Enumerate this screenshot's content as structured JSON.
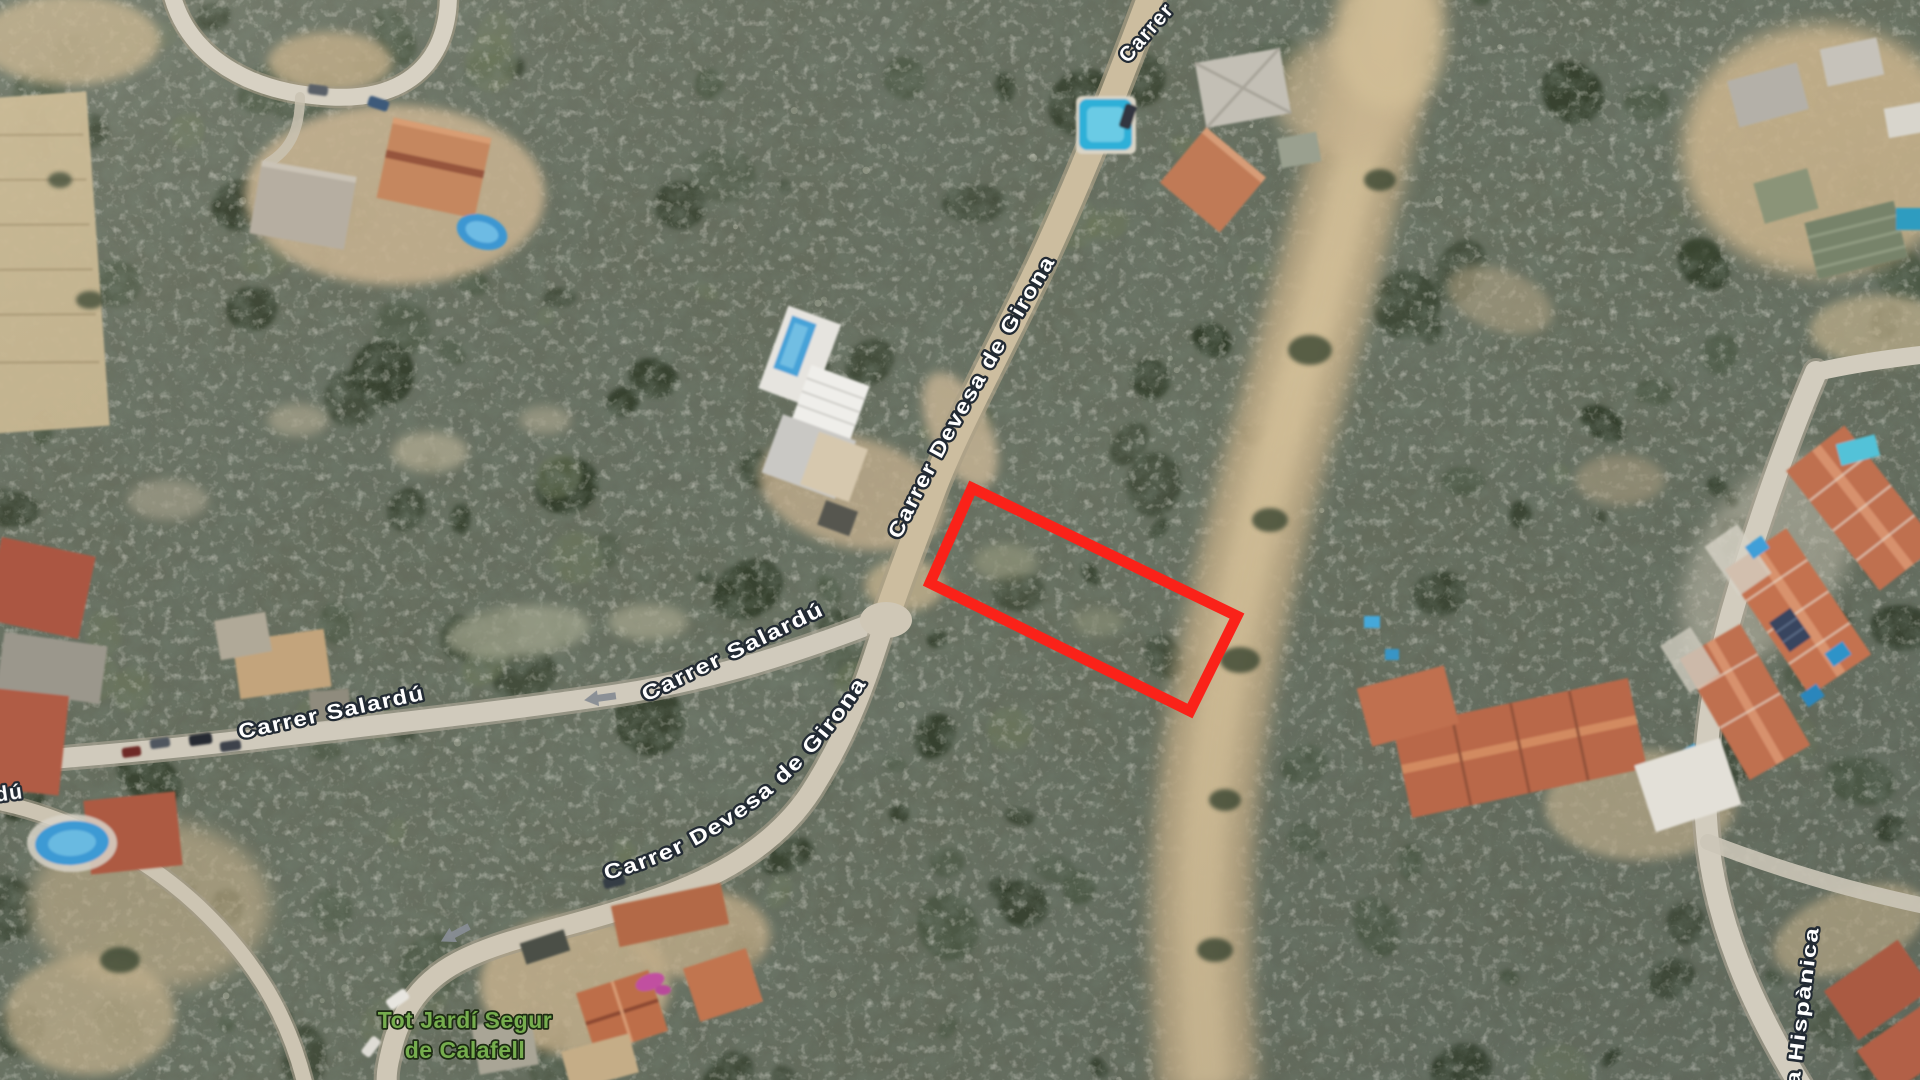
{
  "map_labels": {
    "street_top_partial": "Carrer",
    "street_devesa_upper": "Carrer Devesa de Girona",
    "street_devesa_lower": "Carrer Devesa de Girona",
    "street_salardu_east": "Carrer Salardú",
    "street_salardu_west": "Carrer Salardú",
    "street_salardu_left_partial": "dú",
    "street_hispanica_partial": "a Hispànica"
  },
  "poi": {
    "name_line1": "Tot Jardí Segur",
    "name_line2": "de Calafell",
    "label_color": "#76ad4e"
  },
  "parcel_outline": {
    "points": "972,488 1237,616 1190,711 930,583",
    "color": "#fa2219",
    "stroke_width": 11
  },
  "road_markings": {
    "one_way_arrow_count": 2
  },
  "colors": {
    "street_label_fill": "#ffffff",
    "street_label_outline": "#222a33",
    "road_surface": "#cfc8b8",
    "dirt_road_surface": "#ccbd9f",
    "terrain_base": "#676e5e",
    "arroyo_tan": "#d3bf98",
    "pool_blue": "#3b9ad6",
    "roof_terracotta": "#bf7050",
    "poi_green": "#76ad4e"
  }
}
